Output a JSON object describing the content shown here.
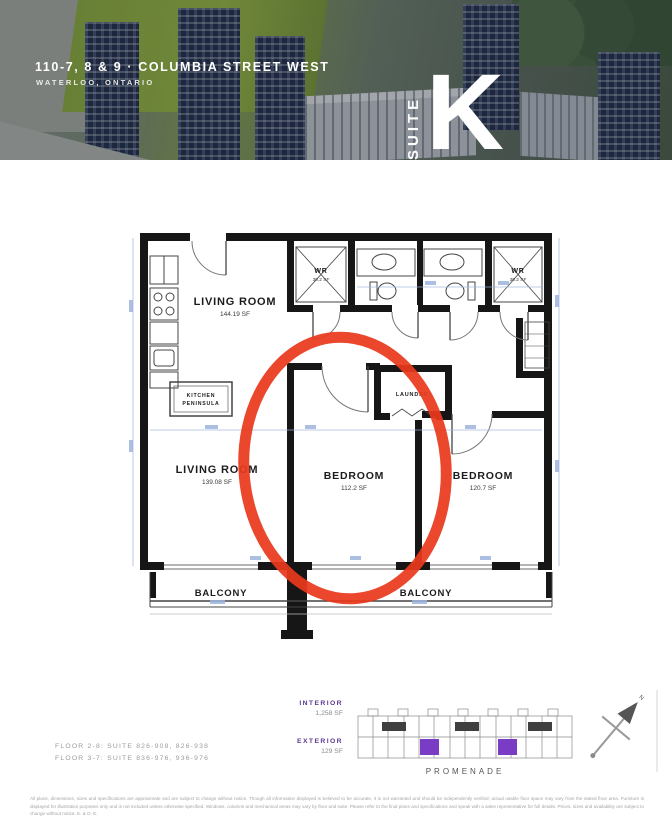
{
  "header": {
    "address": "110-7, 8 & 9 · COLUMBIA STREET WEST",
    "city": "WATERLOO, ONTARIO",
    "suite_label": "SUITE",
    "suite_letter": "K"
  },
  "floorplan": {
    "living_upper": {
      "label": "LIVING ROOM",
      "area": "144.19 SF"
    },
    "living_lower": {
      "label": "LIVING ROOM",
      "area": "139.08 SF"
    },
    "bedroom_circled": {
      "label": "BEDROOM",
      "area": "112.2 SF"
    },
    "bedroom_right": {
      "label": "BEDROOM",
      "area": "120.7 SF"
    },
    "wr_left": {
      "label": "WR",
      "area": "30.2 SF"
    },
    "wr_right": {
      "label": "WR",
      "area": "30.2 SF"
    },
    "laundry": {
      "label": "LAUNDRY"
    },
    "kitchen": {
      "line1": "KITCHEN",
      "line2": "PENINSULA"
    },
    "balcony_left": {
      "label": "BALCONY"
    },
    "balcony_right": {
      "label": "BALCONY"
    }
  },
  "details": {
    "floor_suite_line1": "FLOOR 2-8: SUITE 826-908, 826-938",
    "floor_suite_line2": "FLOOR 3-7: SUITE 836-976, 936-976",
    "interior_label": "INTERIOR",
    "interior_value": "1,258 SF",
    "exterior_label": "EXTERIOR",
    "exterior_value": "129 SF",
    "keyplan_street": "PROMENADE",
    "compass_north": "N"
  },
  "footer": {
    "disclaimer": "All plans, dimensions, sizes and specifications are approximate and are subject to change without notice. Though all information displayed is believed to be accurate, it is not warranted and should be independently verified; actual usable floor space may vary from the stated floor area. Furniture is displayed for illustration purposes only and is not included unless otherwise specified. Windows, columns and mechanical areas may vary by floor and suite. Please refer to the final plans and specifications and speak with a sales representative for full details. Prices, sizes and availability are subject to change without notice. E. & O. E."
  },
  "colors": {
    "annotation_red": "#E8391D",
    "keyplan_purple": "#7A3CC4",
    "label_purple": "#5B3A91",
    "dim_blue": "#9DB4DD"
  }
}
